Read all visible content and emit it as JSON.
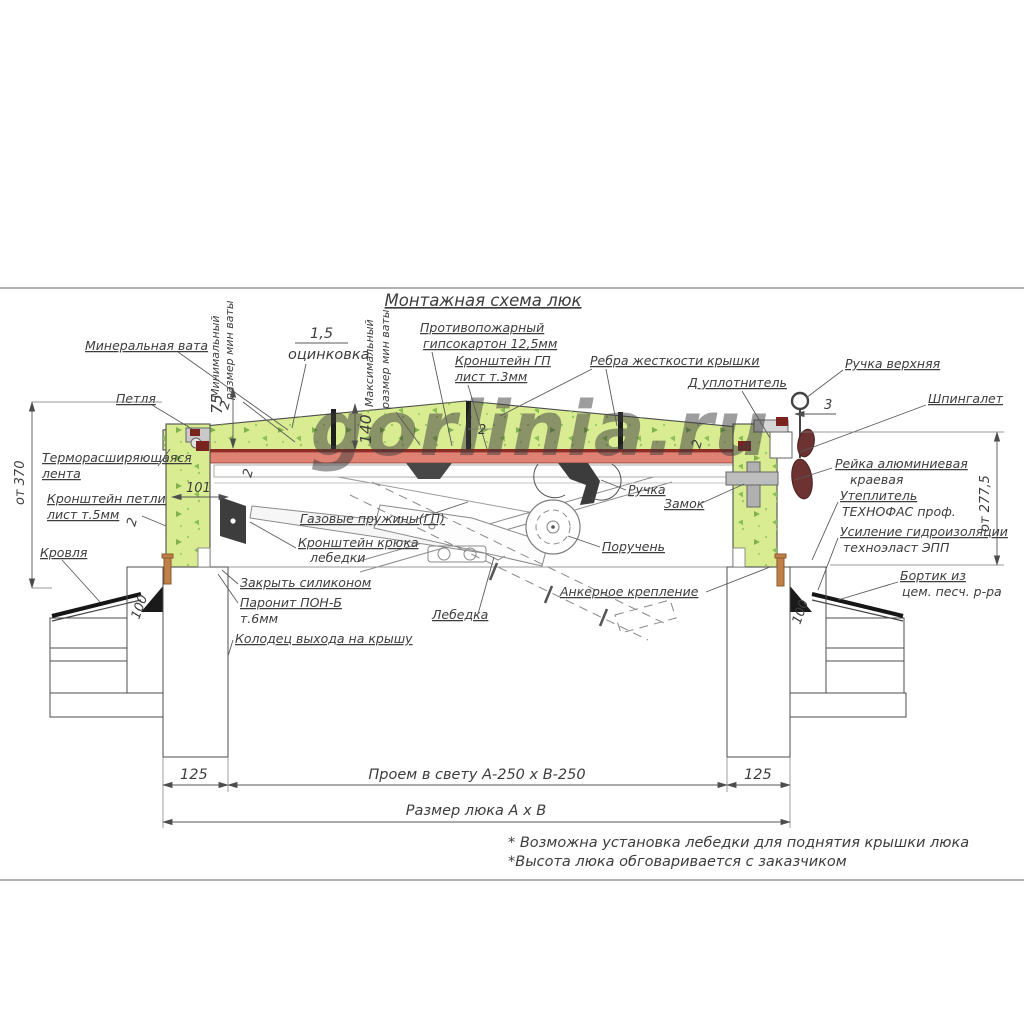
{
  "watermark": "gorlinia.ru",
  "title": "Монтажная схема люк",
  "labels": {
    "zinc_value": "1,5",
    "zinc": "оцинковка",
    "mineral_wool": "Минеральная вата",
    "min_wool_1": "Минимальный",
    "min_wool_2": "размер мин ваты",
    "max_wool_1": "Максимальный",
    "max_wool_2": "размер мин ваты",
    "fireproof_1": "Противопожарный",
    "fireproof_2": "гипсокартон 12,5мм",
    "gp_bracket_1": "Кронштейн ГП",
    "gp_bracket_2": "лист т.3мм",
    "ribs": "Ребра жесткости крышки",
    "d_seal": "Д уплотнитель",
    "top_handle": "Ручка верхняя",
    "latch": "Шпингалет",
    "hinge": "Петля",
    "thermo_tape_1": "Терморасширяющаяся",
    "thermo_tape_2": "лента",
    "hinge_bracket_1": "Кронштейн петли",
    "hinge_bracket_2": "лист т.5мм",
    "roof": "Кровля",
    "gas_springs": "Газовые пружины(ГП)",
    "hook_bracket_1": "Кронштейн крюка",
    "hook_bracket_2": "лебедки",
    "silicone": "Закрыть силиконом",
    "paronite_1": "Паронит ПОН-Б",
    "paronite_2": "т.6мм",
    "well": "Колодец выхода на крышу",
    "winch": "Лебедка",
    "handle": "Ручка",
    "lock": "Замок",
    "handrail": "Поручень",
    "anchor": "Анкерное крепление",
    "alu_rail_1": "Рейка алюминиевая",
    "alu_rail_2": "краевая",
    "insulation_1": "Утеплитель",
    "insulation_2": "ТЕХНОФАС проф.",
    "waterproofing_1": "Усиление гидроизоляции",
    "waterproofing_2": "техноэласт ЭПП",
    "curb_1": "Бортик из",
    "curb_2": "цем. песч. р-ра"
  },
  "dimensions": {
    "left_height": "от 370",
    "right_height": "от 277,5",
    "wool_min": "75",
    "wool_max": "140",
    "frame_width": "101",
    "wall_ins_left": "100",
    "wall_ins_right": "100",
    "latch_gap": "3",
    "t2_a": "2",
    "t2_b": "2",
    "t2_c": "2",
    "t2_d": "2",
    "t2_e": "2",
    "offset_left": "125",
    "offset_right": "125",
    "clear_opening": "Проем в свету А-250 х В-250",
    "hatch_size": "Размер люка А х В"
  },
  "notes": {
    "note1": "* Возможна установка лебедки для поднятия крышки люка",
    "note2": "*Высота люка обговаривается с заказчиком"
  },
  "colors": {
    "wool_green": "#d9ec92",
    "flange_red": "#e08273",
    "flange_dark": "#8d2b24",
    "seal_dark_red": "#7a241f",
    "latch_handle": "#6d3232",
    "anchor_brown": "#c08048",
    "watermark_green": "#85ad74",
    "dark_part": "#3d3d3d"
  }
}
